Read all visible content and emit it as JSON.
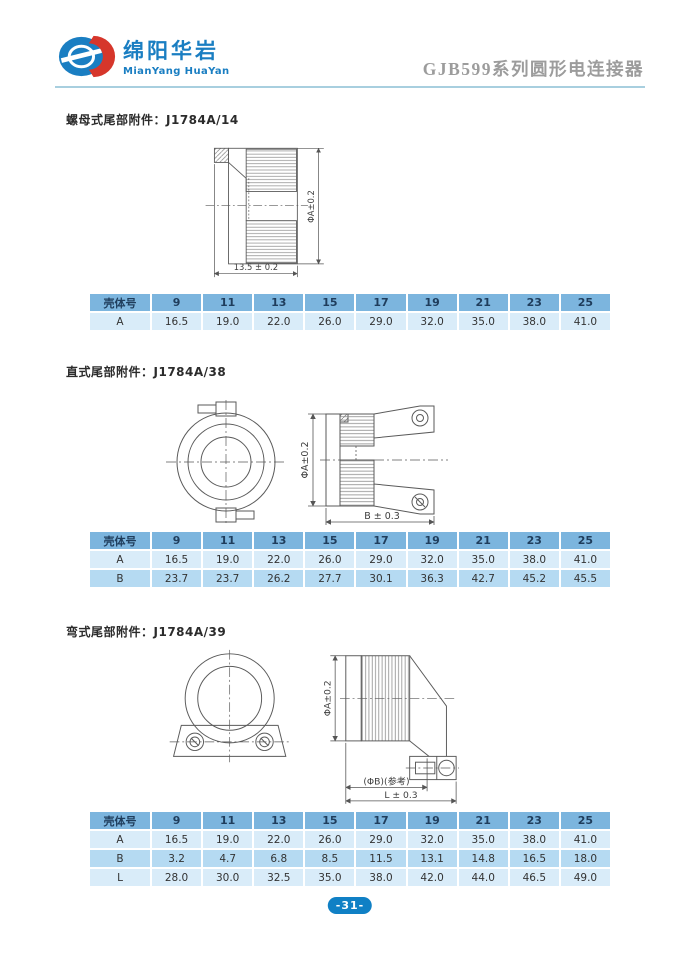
{
  "colors": {
    "brand-blue": "#1a7ec2",
    "brand-red": "#d6362b",
    "title-gray": "#9c9c9c",
    "header-line": "#a8cfdf",
    "table-header-bg": "#7cb5de",
    "table-header-text": "#1f3d5c",
    "row-light": "#d9ecf9",
    "row-medium": "#b5daf2",
    "cell-text": "#333333",
    "badge-bg": "#1080c5",
    "stroke": "#5a5a5a"
  },
  "header": {
    "logo_cn": "绵阳华岩",
    "logo_en": "MianYang HuaYan",
    "title": "GJB599系列圆形电连接器"
  },
  "sections": [
    {
      "title": "螺母式尾部附件：J1784A/14",
      "dims": {
        "dia": "ΦA±0.2",
        "len": "13.5 ± 0.2"
      },
      "table": {
        "header": [
          "壳体号",
          "9",
          "11",
          "13",
          "15",
          "17",
          "19",
          "21",
          "23",
          "25"
        ],
        "rows": [
          [
            "A",
            "16.5",
            "19.0",
            "22.0",
            "26.0",
            "29.0",
            "32.0",
            "35.0",
            "38.0",
            "41.0"
          ]
        ]
      }
    },
    {
      "title": "直式尾部附件：J1784A/38",
      "dims": {
        "dia": "ΦA±0.2",
        "len": "B ± 0.3"
      },
      "table": {
        "header": [
          "壳体号",
          "9",
          "11",
          "13",
          "15",
          "17",
          "19",
          "21",
          "23",
          "25"
        ],
        "rows": [
          [
            "A",
            "16.5",
            "19.0",
            "22.0",
            "26.0",
            "29.0",
            "32.0",
            "35.0",
            "38.0",
            "41.0"
          ],
          [
            "B",
            "23.7",
            "23.7",
            "26.2",
            "27.7",
            "30.1",
            "36.3",
            "42.7",
            "45.2",
            "45.5"
          ]
        ]
      }
    },
    {
      "title": "弯式尾部附件：J1784A/39",
      "dims": {
        "dia": "ΦA±0.2",
        "dia_b": "(ΦB)(参考)",
        "len": "L ± 0.3"
      },
      "table": {
        "header": [
          "壳体号",
          "9",
          "11",
          "13",
          "15",
          "17",
          "19",
          "21",
          "23",
          "25"
        ],
        "rows": [
          [
            "A",
            "16.5",
            "19.0",
            "22.0",
            "26.0",
            "29.0",
            "32.0",
            "35.0",
            "38.0",
            "41.0"
          ],
          [
            "B",
            "3.2",
            "4.7",
            "6.8",
            "8.5",
            "11.5",
            "13.1",
            "14.8",
            "16.5",
            "18.0"
          ],
          [
            "L",
            "28.0",
            "30.0",
            "32.5",
            "35.0",
            "38.0",
            "42.0",
            "44.0",
            "46.5",
            "49.0"
          ]
        ]
      }
    }
  ],
  "footer": {
    "page_number": "-31-"
  }
}
